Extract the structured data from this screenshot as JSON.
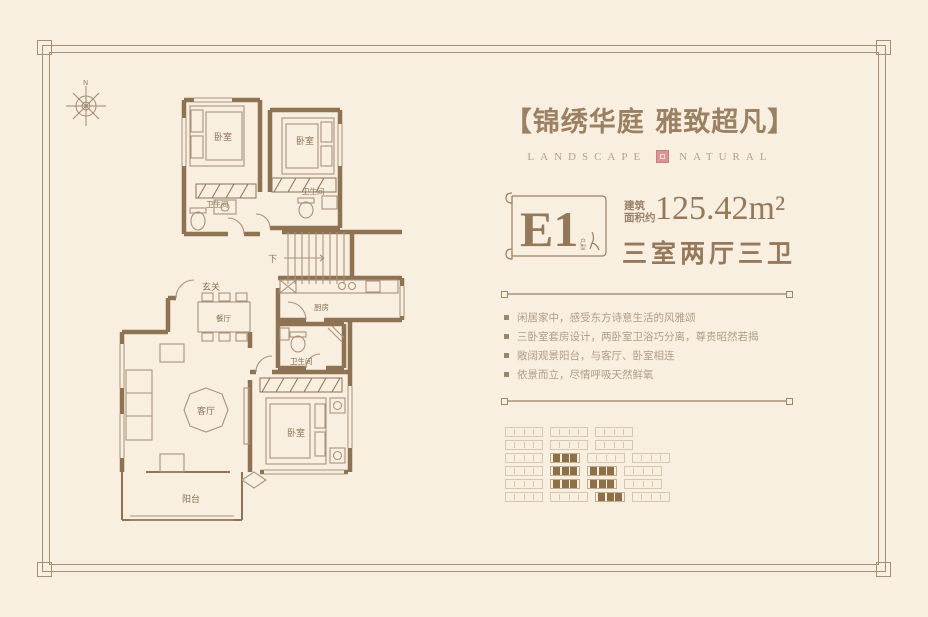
{
  "colors": {
    "background": "#f8efe1",
    "frame": "#a58f74",
    "gold_text": "#9b8061",
    "wall": "#8d7352",
    "seal_pink": "#dc9494",
    "pattern_fill": "#8d7048"
  },
  "header": {
    "title": "【锦绣华庭 雅致超凡】",
    "brand_left": "LANDSCAPE",
    "brand_right": "NATURAL"
  },
  "unit": {
    "code": "E1",
    "code_tag": "户型",
    "area_label_line1": "建筑",
    "area_label_line2": "面积约",
    "area_value": "125.42m²",
    "rooms_summary": "三室两厅三卫"
  },
  "features": [
    "闲居家中，感受东方诗意生活的风雅颂",
    "三卧室套房设计，两卧室卫浴巧分离，尊贵昭然若揭",
    "敞阔观景阳台，与客厅、卧室相连",
    "依景而立，尽情呼吸天然鲜氧"
  ],
  "floorplan": {
    "compass": "N",
    "labels": {
      "bedroom_a": "卧室",
      "bedroom_b": "卧室",
      "bedroom_c": "卧室",
      "bath_a": "卫生间",
      "bath_b": "卫生间",
      "bath_c": "卫生间",
      "foyer": "玄关",
      "dining": "餐厅",
      "kitchen": "厨房",
      "living": "客厅",
      "balcony": "阳台",
      "stairs_down": "下"
    }
  },
  "siteplan": {
    "rows": [
      [
        "o",
        "o",
        "o"
      ],
      [
        "o",
        "o",
        "o"
      ],
      [
        "o",
        "f",
        "o",
        "o"
      ],
      [
        "o",
        "f",
        "f",
        "o"
      ],
      [
        "o",
        "f",
        "f",
        "o"
      ],
      [
        "o",
        "o",
        "f",
        "o"
      ]
    ]
  }
}
